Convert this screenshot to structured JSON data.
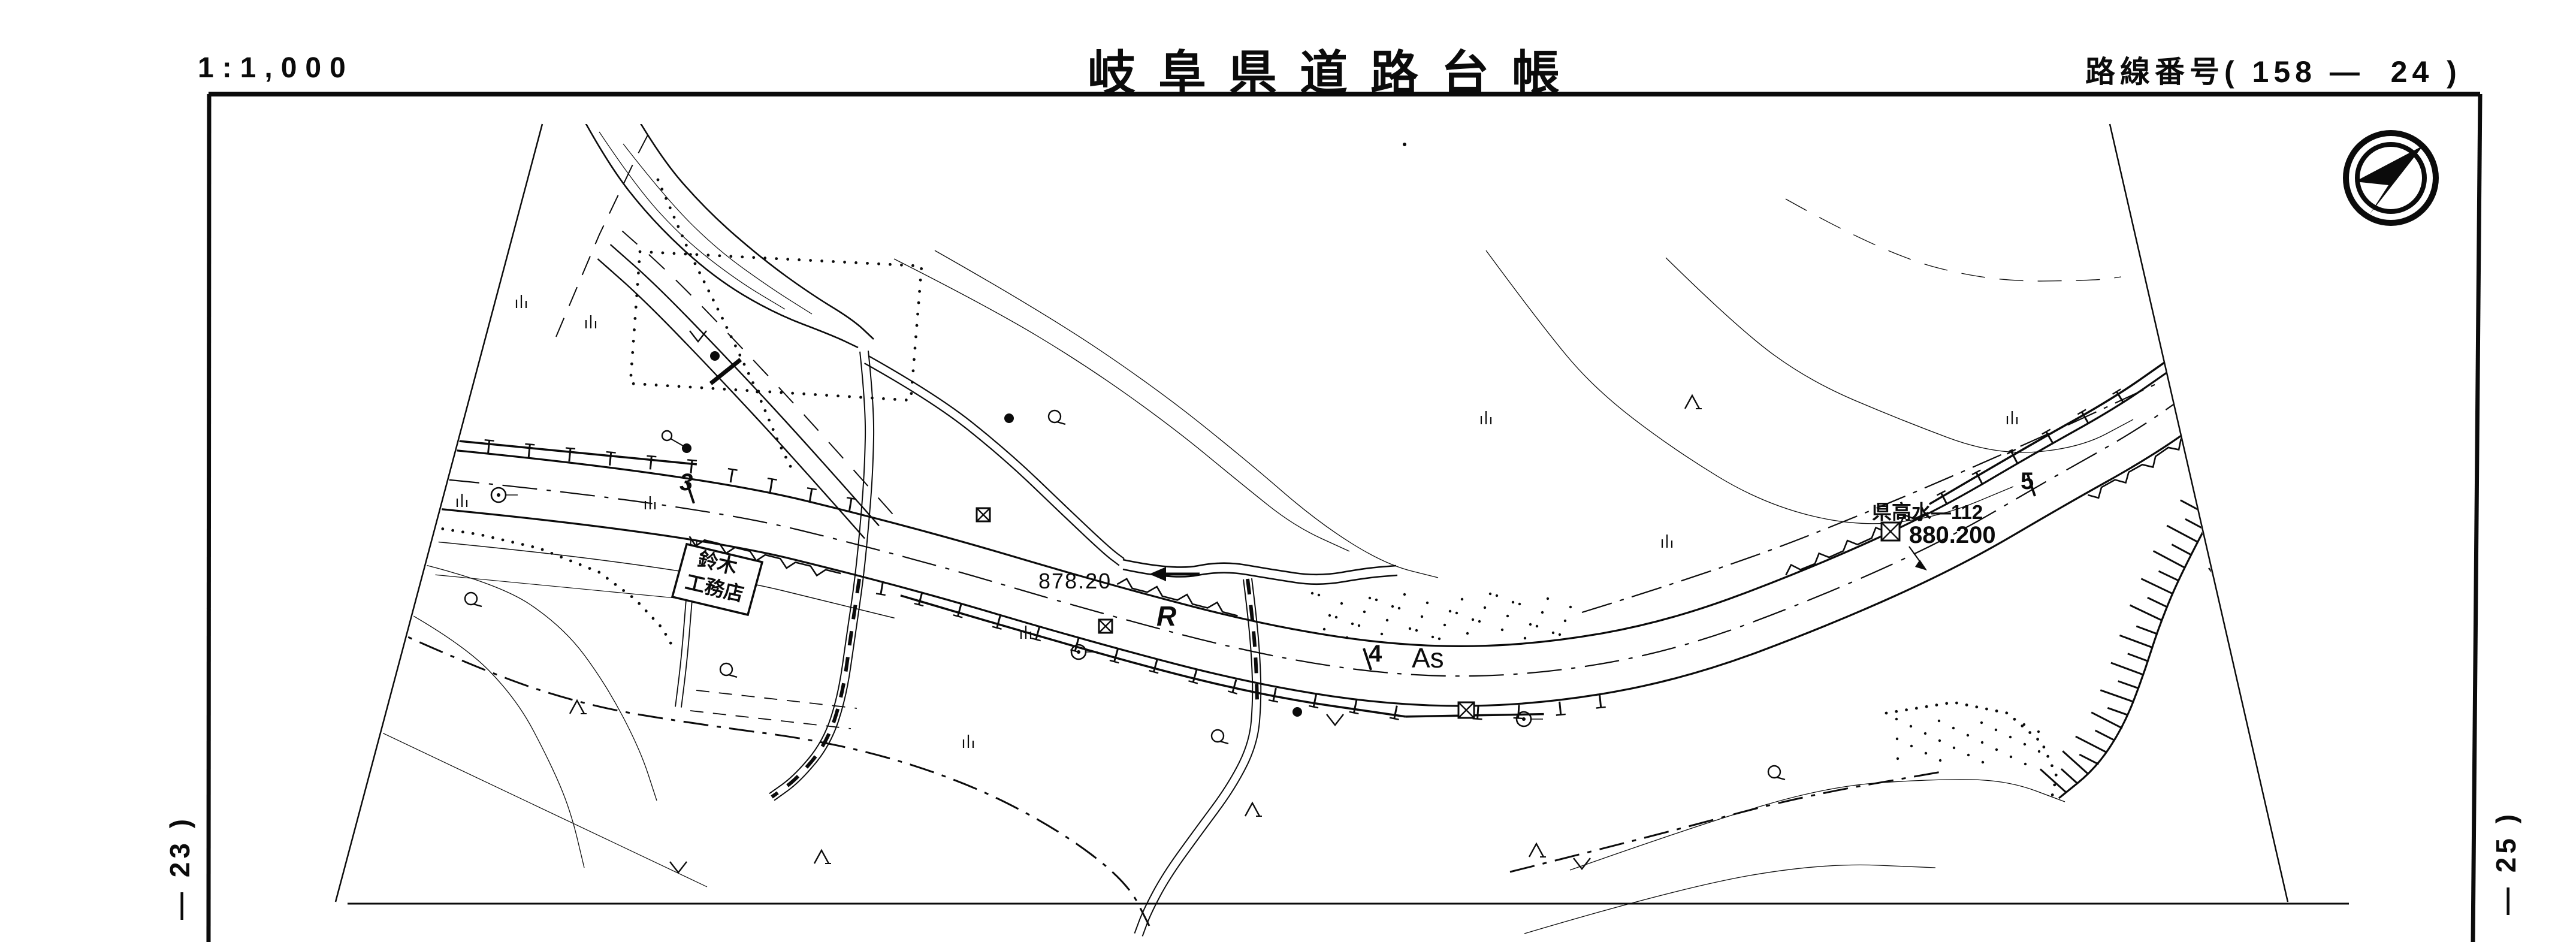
{
  "header": {
    "scale": "1:1,000",
    "title": "岐阜県道路台帳",
    "route_number": "路線番号( 158 —  24 )"
  },
  "sheet_refs": {
    "left": "— 23 )",
    "right": "— 25 )"
  },
  "map": {
    "paper_color": "#ffffff",
    "ink_color": "#0b0b0b",
    "labels": {
      "building_name_line1": "鈴木",
      "building_name_line2": "工務店",
      "spot_elevation": "878.20",
      "retaining_wall_mark": "R",
      "station_3": "3",
      "station_4": "4",
      "station_5": "5",
      "pavement_type": "As",
      "benchmark_name": "県高水—112",
      "benchmark_elevation": "880.200"
    },
    "icons": {
      "north_arrow": "north-arrow",
      "benchmark": "crossed-box-benchmark"
    }
  }
}
